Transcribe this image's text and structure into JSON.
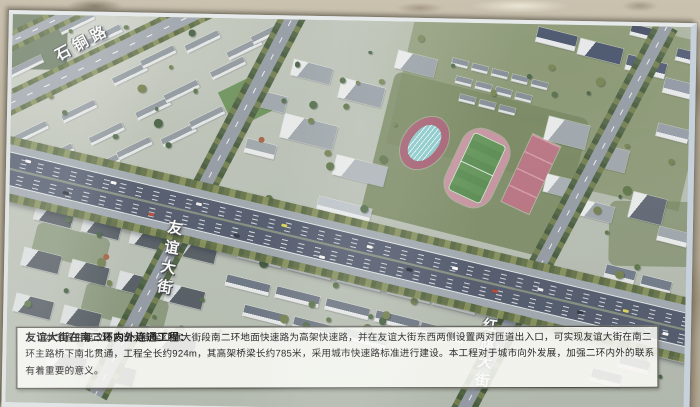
{
  "billboard": {
    "road_labels": {
      "shitong": "石铜路",
      "youyi": "友谊大街",
      "hongqi": "红旗大街"
    },
    "info_panel": {
      "title": "友谊大街在南二环内外连通工程：",
      "body": "本工程主要改造友谊大街至红旗大街段南二环地面快速路为高架快速路，并在友谊大街东西两侧设置两对匝道出入口，可实现友谊大街在南二环主路桥下南北贯通，工程全长约924m，其高架桥梁长约785米，采用城市快速路标准进行建设。本工程对于城市向外发展，加强二环内外的联系有着重要的意义。"
    },
    "colors": {
      "expressway_asphalt": "#4a5468",
      "minor_road": "#8e96a0",
      "roadside_trees": "#6b7a45",
      "soccer_field_green": "#4f8745",
      "running_track_pink": "#c58d9b",
      "pool_teal": "#7ec6c8",
      "courts_red": "#b96c7c",
      "wall_tan": "#bdb3a0",
      "frame_white": "#e7eaeb",
      "panel_background": "#faf9f4",
      "label_text": "#f7f7f5"
    }
  }
}
